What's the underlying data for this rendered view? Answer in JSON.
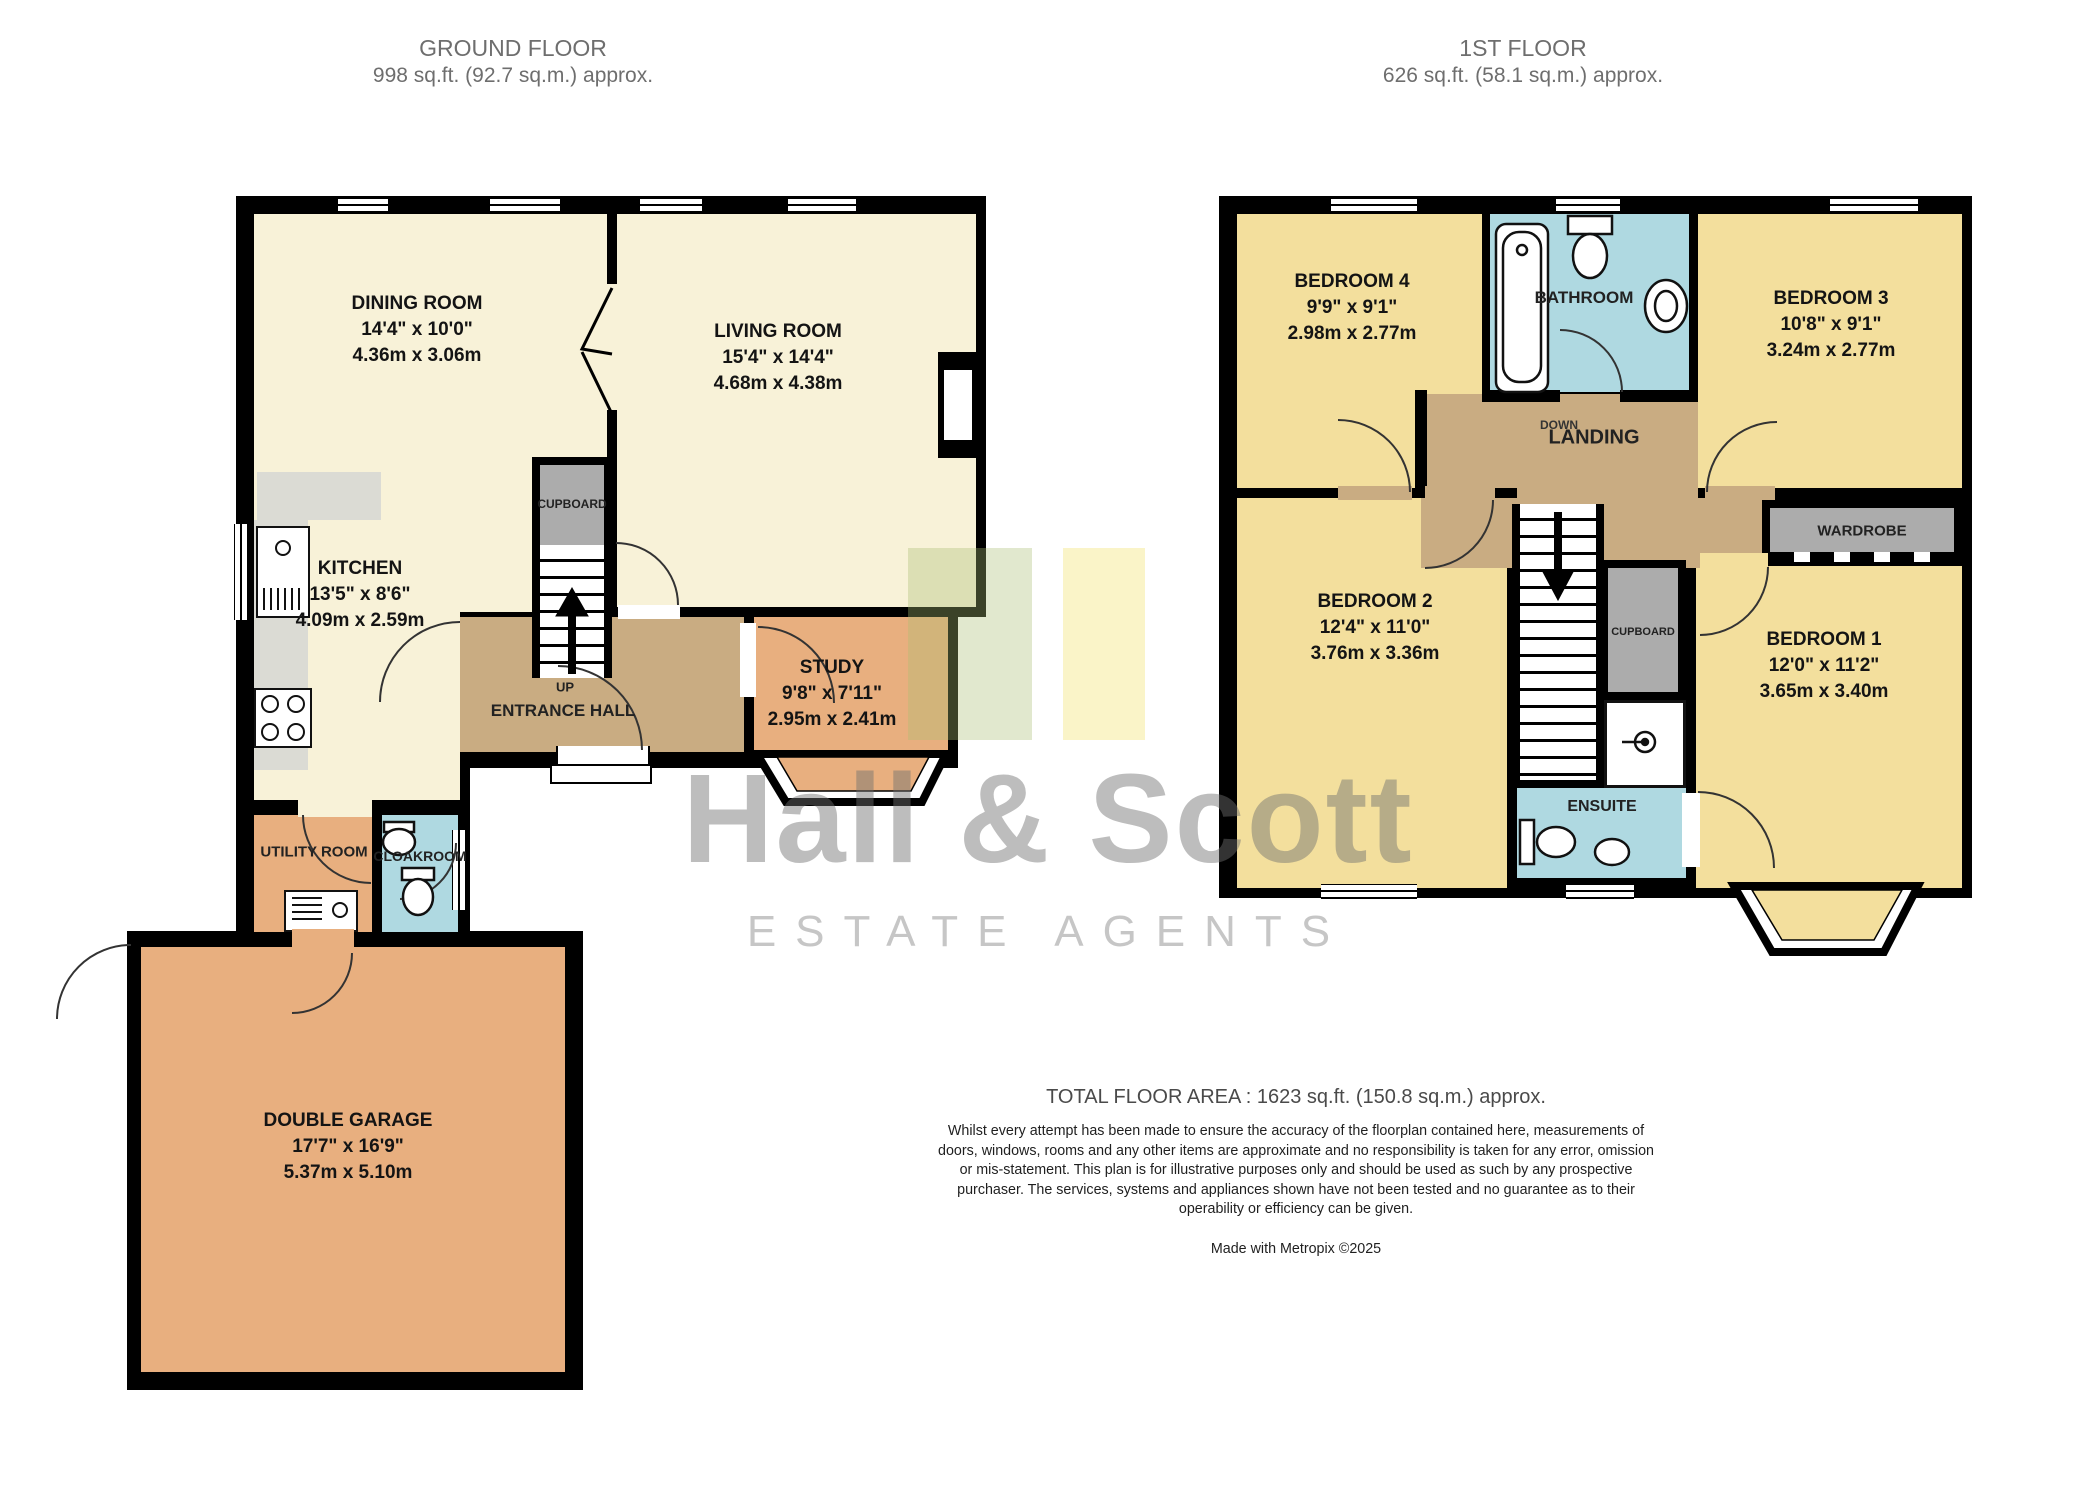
{
  "colors": {
    "wall": "#000000",
    "reception_cream": "#F8F2D8",
    "bedroom_yellow": "#F3DF9D",
    "orange_room": "#E8AF7F",
    "hall_tan": "#C9AC82",
    "wet_room_blue": "#AFD9E1",
    "storage_grey": "#ACACAC",
    "watermark_grey": "#BABABA"
  },
  "headers": {
    "ground": {
      "title": "GROUND FLOOR",
      "area": "998 sq.ft. (92.7 sq.m.) approx."
    },
    "first": {
      "title": "1ST FLOOR",
      "area": "626 sq.ft. (58.1 sq.m.) approx."
    }
  },
  "ground_floor": {
    "dining_room": {
      "name": "DINING ROOM",
      "imperial": "14'4\" x 10'0\"",
      "metric": "4.36m x 3.06m"
    },
    "living_room": {
      "name": "LIVING ROOM",
      "imperial": "15'4\" x 14'4\"",
      "metric": "4.68m x 4.38m"
    },
    "kitchen": {
      "name": "KITCHEN",
      "imperial": "13'5\" x 8'6\"",
      "metric": "4.09m x 2.59m"
    },
    "study": {
      "name": "STUDY",
      "imperial": "9'8\" x 7'11\"",
      "metric": "2.95m x 2.41m"
    },
    "garage": {
      "name": "DOUBLE GARAGE",
      "imperial": "17'7\" x 16'9\"",
      "metric": "5.37m x 5.10m"
    },
    "entrance_hall": "ENTRANCE HALL",
    "up": "UP",
    "cupboard": "CUPBOARD",
    "utility_room": "UTILITY ROOM",
    "cloakroom": "CLOAKROOM"
  },
  "first_floor": {
    "bedroom1": {
      "name": "BEDROOM 1",
      "imperial": "12'0\" x 11'2\"",
      "metric": "3.65m x 3.40m"
    },
    "bedroom2": {
      "name": "BEDROOM 2",
      "imperial": "12'4\" x 11'0\"",
      "metric": "3.76m x 3.36m"
    },
    "bedroom3": {
      "name": "BEDROOM 3",
      "imperial": "10'8\" x 9'1\"",
      "metric": "3.24m x 2.77m"
    },
    "bedroom4": {
      "name": "BEDROOM 4",
      "imperial": "9'9\" x 9'1\"",
      "metric": "2.98m x 2.77m"
    },
    "bathroom": "BATHROOM",
    "landing": "LANDING",
    "down": "DOWN",
    "wardrobe": "WARDROBE",
    "cupboard": "CUPBOARD",
    "ensuite": "ENSUITE"
  },
  "watermark": {
    "line1": "Hall & Scott",
    "line2": "ESTATE AGENTS"
  },
  "footer": {
    "total": "TOTAL FLOOR AREA : 1623 sq.ft. (150.8 sq.m.) approx.",
    "disclaimer": "Whilst every attempt has been made to ensure the accuracy of the floorplan contained here, measurements of doors, windows, rooms and any other items are approximate and no responsibility is taken for any error, omission or mis-statement. This plan is for illustrative purposes only and should be used as such by any prospective purchaser. The services, systems and appliances shown have not been tested and no guarantee as to their operability or efficiency can be given.",
    "credit": "Made with Metropix ©2025"
  }
}
